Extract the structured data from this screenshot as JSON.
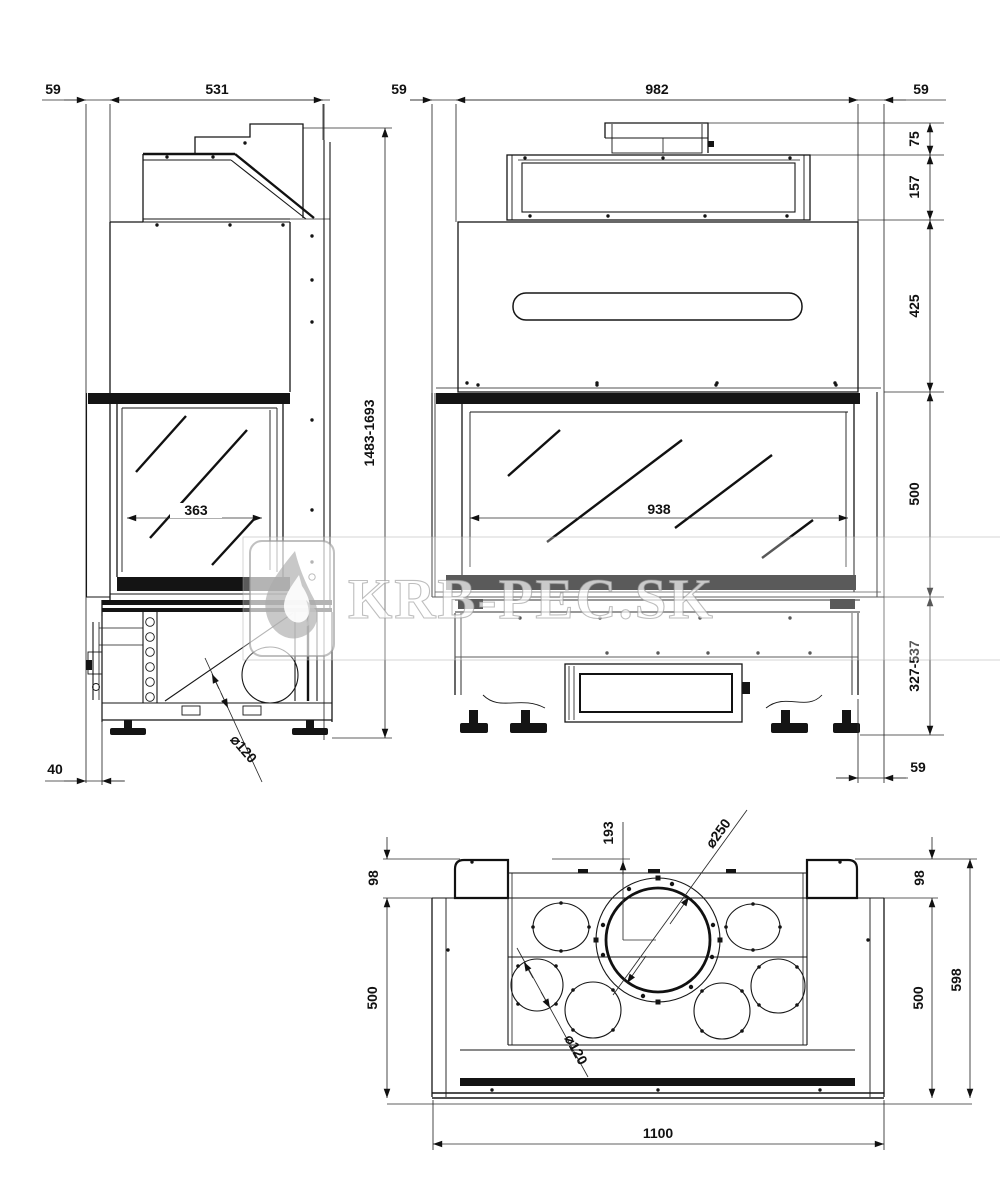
{
  "watermark": {
    "text": "KRB-PEC.SK"
  },
  "side": {
    "offset": "59",
    "depth": "531",
    "glass": "363",
    "height": "1483-1693",
    "base_offset": "40",
    "flue": "⌀120"
  },
  "front": {
    "offset_left": "59",
    "width": "982",
    "offset_right": "59",
    "stub": "75",
    "collar": "157",
    "hood": "425",
    "glass_h": "500",
    "base": "327-537",
    "glass_w": "938",
    "offset_bottom": "59"
  },
  "plan": {
    "center": "193",
    "collar_dia": "⌀250",
    "hole_dia": "⌀120",
    "rear_left": "98",
    "rear_right": "98",
    "depth_left": "500",
    "depth_right": "500",
    "depth_total": "598",
    "width_total": "1100"
  }
}
